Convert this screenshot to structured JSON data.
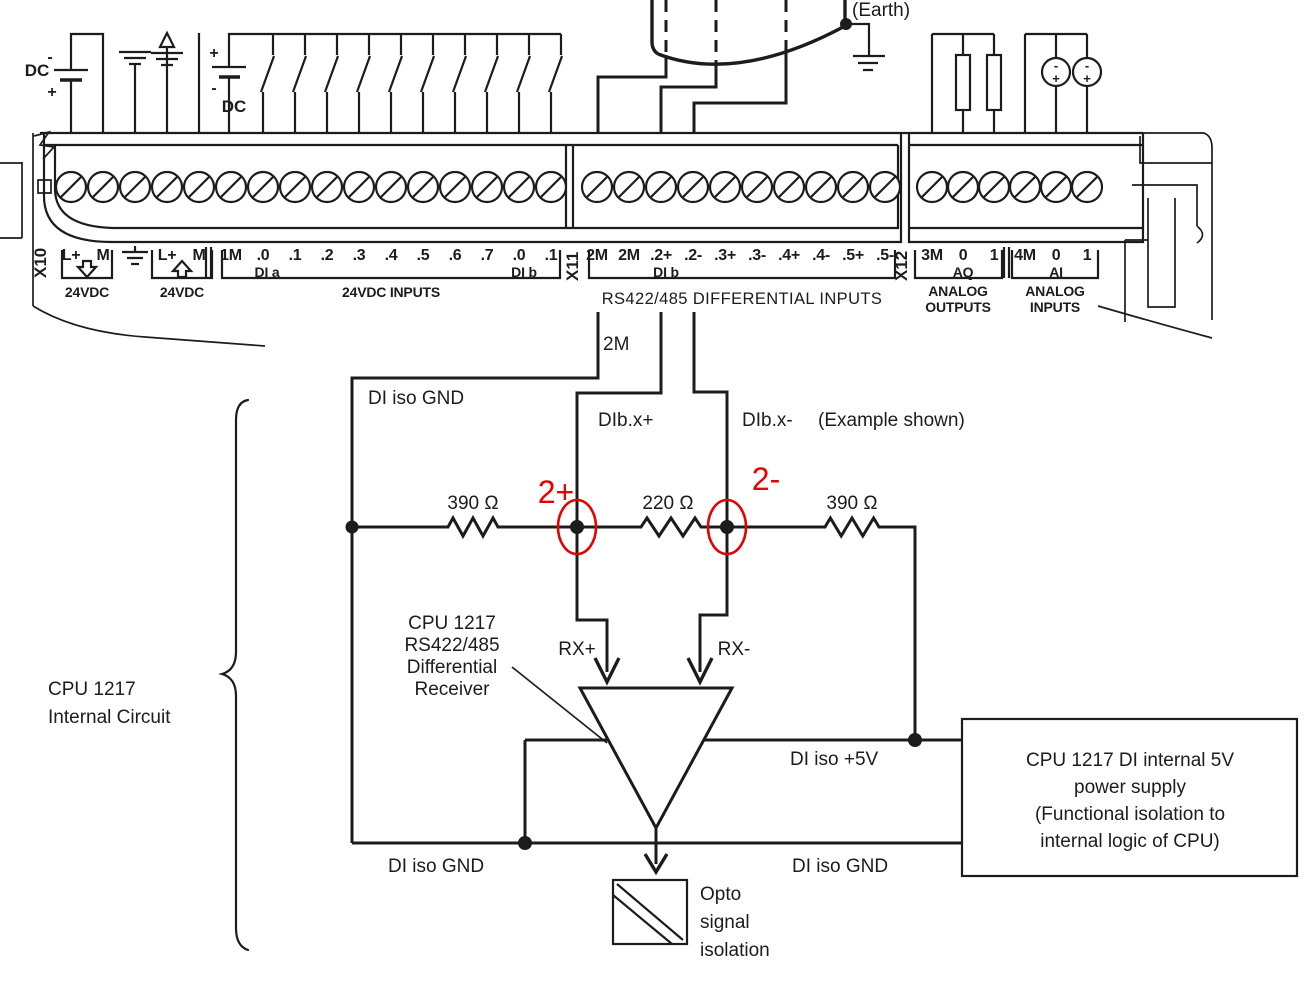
{
  "colors": {
    "ink": "#1c1c1c",
    "red": "#e60000",
    "background": "#ffffff"
  },
  "top": {
    "earth_label": "(Earth)",
    "battery_left": {
      "label": "DC",
      "minus": "-",
      "plus": "+"
    },
    "battery_input": {
      "label": "DC",
      "minus": "-",
      "plus": "+"
    },
    "analog_sources": [
      {
        "minus": "-",
        "plus": "+"
      },
      {
        "minus": "-",
        "plus": "+"
      }
    ]
  },
  "terminal_labels": {
    "x10": "X10",
    "x11": "X11",
    "x12": "X12",
    "blockA": [
      "L+",
      "M",
      "⏚",
      "L+",
      "M",
      "1M",
      ".0",
      ".1",
      ".2",
      ".3",
      ".4",
      ".5",
      ".6",
      ".7",
      ".0",
      ".1"
    ],
    "x11_terms": [
      "2M",
      "2M",
      ".2+",
      ".2-",
      ".3+",
      ".3-",
      ".4+",
      ".4-",
      ".5+",
      ".5-"
    ],
    "x12_terms": [
      "3M",
      "0",
      "1",
      "4M",
      "0",
      "1"
    ],
    "captions": {
      "vdc_in": "24VDC",
      "vdc_out": "24VDC",
      "vdc_inputs": "24VDC INPUTS",
      "rs422": "RS422/485 DIFFERENTIAL INPUTS",
      "analog_out_1": "ANALOG",
      "analog_out_2": "OUTPUTS",
      "analog_in_1": "ANALOG",
      "analog_in_2": "INPUTS",
      "di_a": "DI a",
      "di_b": "DI b",
      "di_b_x11": "DI b",
      "aq": "AQ",
      "ai": "AI"
    }
  },
  "circuit": {
    "wire_2m": "2M",
    "di_iso_gnd_top": "DI iso GND",
    "dib_x_plus": "DIb.x+",
    "dib_x_minus": "DIb.x-",
    "example": "(Example shown)",
    "r_left": "390 Ω",
    "r_mid": "220 Ω",
    "r_right": "390 Ω",
    "probe_plus": "2+",
    "probe_minus": "2-",
    "receiver_lines": [
      "CPU 1217",
      "RS422/485",
      "Differential",
      "Receiver"
    ],
    "rx_plus": "RX+",
    "rx_minus": "RX-",
    "di_iso_5v": "DI iso +5V",
    "di_iso_gnd_left": "DI iso GND",
    "di_iso_gnd_right": "DI iso GND",
    "opto_lines": [
      "Opto",
      "signal",
      "isolation"
    ],
    "psu_lines": [
      "CPU 1217 DI internal 5V",
      "power supply",
      "(Functional isolation to",
      "internal logic of CPU)"
    ],
    "internal_lines": [
      "CPU 1217",
      "Internal Circuit"
    ]
  }
}
